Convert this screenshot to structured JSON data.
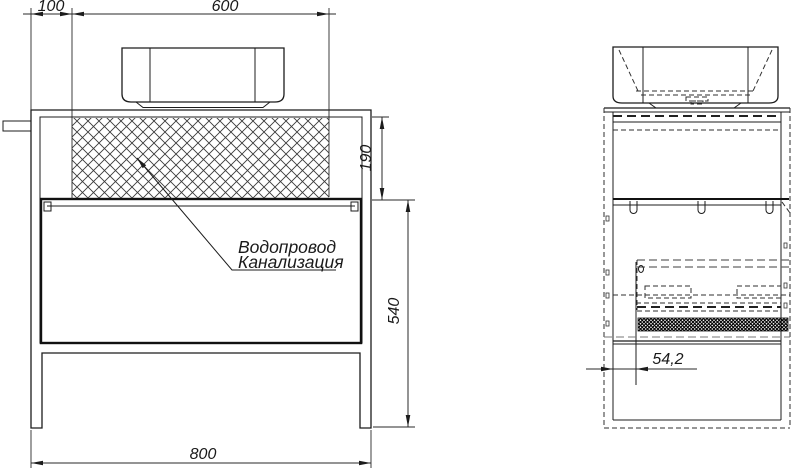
{
  "colors": {
    "line": "#1c1c1c",
    "background": "#ffffff"
  },
  "front_view": {
    "dim_left_offset": "100",
    "dim_sink_width": "600",
    "dim_backsplash_height": "190",
    "dim_body_height": "540",
    "dim_total_width": "800",
    "label_water_supply": "Водопровод",
    "label_sewerage": "Канализация"
  },
  "side_view": {
    "dim_front_offset": "54,2"
  }
}
